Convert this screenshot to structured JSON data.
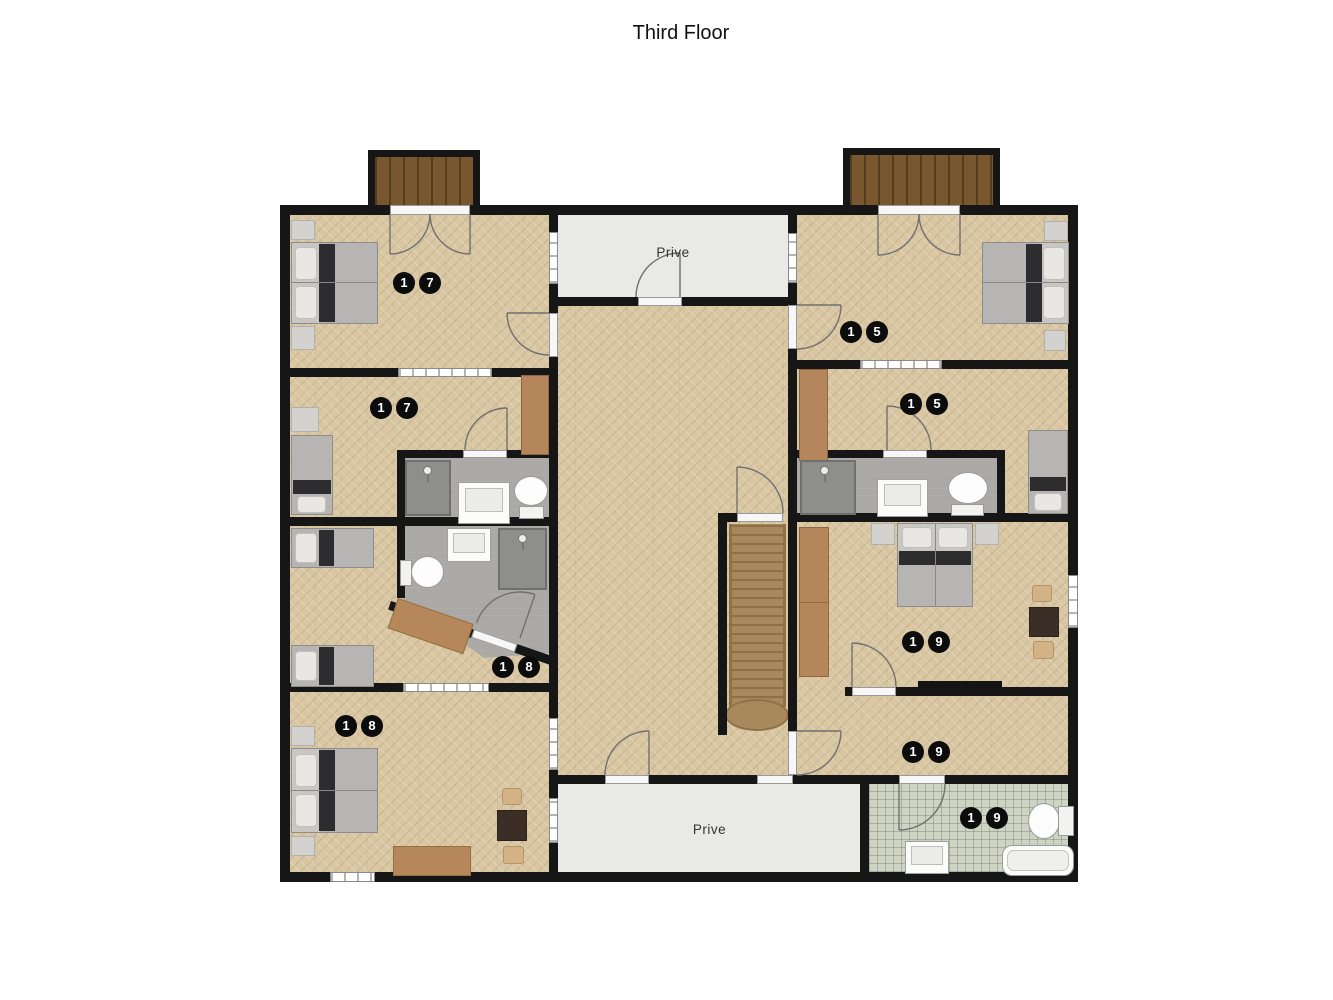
{
  "title": "Third Floor",
  "areas": {
    "prive_top": "Prive",
    "prive_bottom": "Prive"
  },
  "room_badges": [
    {
      "id": "room-17-top",
      "digits": [
        "1",
        "7"
      ]
    },
    {
      "id": "room-17-mid",
      "digits": [
        "1",
        "7"
      ]
    },
    {
      "id": "room-18-mid",
      "digits": [
        "1",
        "8"
      ]
    },
    {
      "id": "room-18-bottom",
      "digits": [
        "1",
        "8"
      ]
    },
    {
      "id": "room-15-top",
      "digits": [
        "1",
        "5"
      ]
    },
    {
      "id": "room-15-mid",
      "digits": [
        "1",
        "5"
      ]
    },
    {
      "id": "room-19-main",
      "digits": [
        "1",
        "9"
      ]
    },
    {
      "id": "room-19-lower",
      "digits": [
        "1",
        "9"
      ]
    },
    {
      "id": "room-19-bath",
      "digits": [
        "1",
        "9"
      ]
    }
  ],
  "colors": {
    "wall": "#161616",
    "floor_wood": "#d9c7a3",
    "floor_prive": "#e9e9e7",
    "floor_bath": "#aaa9a5",
    "floor_tile": "#cfd3c3",
    "balcony_wood": "#78572f",
    "stairs": "#a8895c",
    "badge_bg": "#0c0c0c",
    "badge_text": "#ffffff"
  }
}
